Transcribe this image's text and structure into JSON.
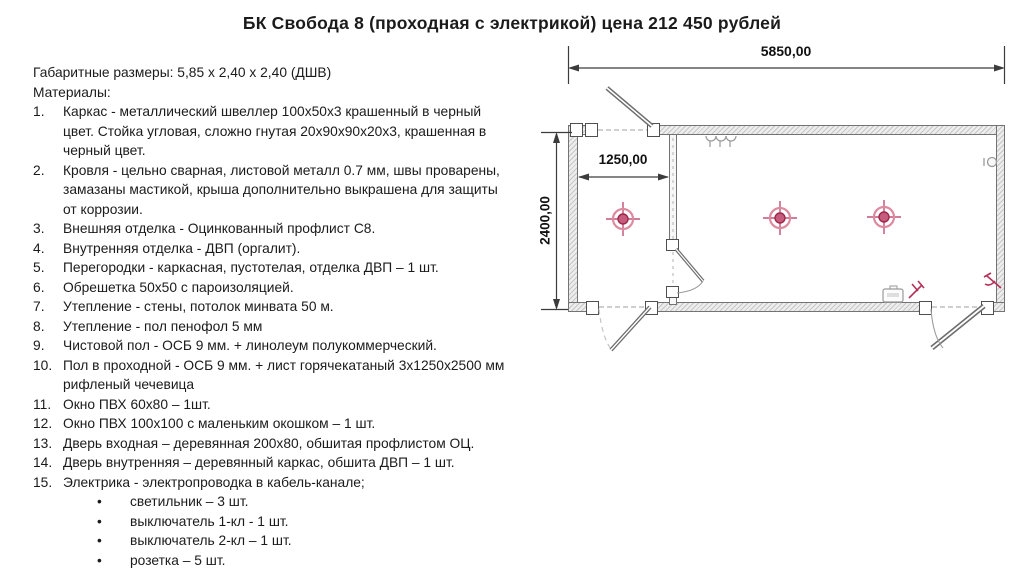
{
  "title": "БК Свобода 8 (проходная с электрикой) цена 212 450 рублей",
  "specs": {
    "dimensions_line": "Габаритные размеры: 5,85 х 2,40 х 2,40 (ДШВ)",
    "materials_label": "Материалы:",
    "materials": [
      "Каркас - металлический швеллер 100х50х3 крашенный в черный цвет. Стойка угловая, сложно гнутая 20х90х90х20х3, крашенная в черный цвет.",
      "Кровля - цельно сварная, листовой металл 0.7 мм, швы проварены, замазаны мастикой, крыша дополнительно выкрашена для защиты от коррозии.",
      "Внешняя отделка - Оцинкованный профлист С8.",
      "Внутренняя отделка - ДВП (оргалит).",
      "Перегородки - каркасная, пустотелая, отделка ДВП – 1 шт.",
      "Обрешетка 50х50 с пароизоляцией.",
      "Утепление - стены, потолок минвата 50 м.",
      "Утепление - пол пенофол 5 мм",
      "Чистовой пол - ОСБ 9 мм. + линолеум полукоммерческий.",
      "Пол в проходной  - ОСБ 9 мм. + лист горячекатаный 3х1250х2500 мм рифленый чечевица",
      "Окно ПВХ 60х80 – 1шт.",
      "Окно ПВХ 100х100 с маленьким окошком – 1 шт.",
      "Дверь входная – деревянная 200х80, обшитая профлистом ОЦ.",
      "Дверь внутренняя – деревянный каркас, обшита ДВП – 1 шт.",
      "Электрика - электропроводка в кабель-канале;"
    ],
    "electrics": [
      "светильник – 3 шт.",
      "выключатель 1-кл -  1 шт.",
      "выключатель 2-кл – 1 шт.",
      "розетка – 5 шт.",
      "автомат на 16А - 1 шт."
    ]
  },
  "diagram": {
    "dim_width": "5850,00",
    "dim_room": "1250,00",
    "dim_height": "2400,00",
    "lights_count": 3,
    "colors": {
      "symbol_red": "#b5315a",
      "symbol_pink": "#dd8aa0",
      "wall_gray": "#d9d9d9",
      "line_dark": "#3c3c3c"
    }
  }
}
